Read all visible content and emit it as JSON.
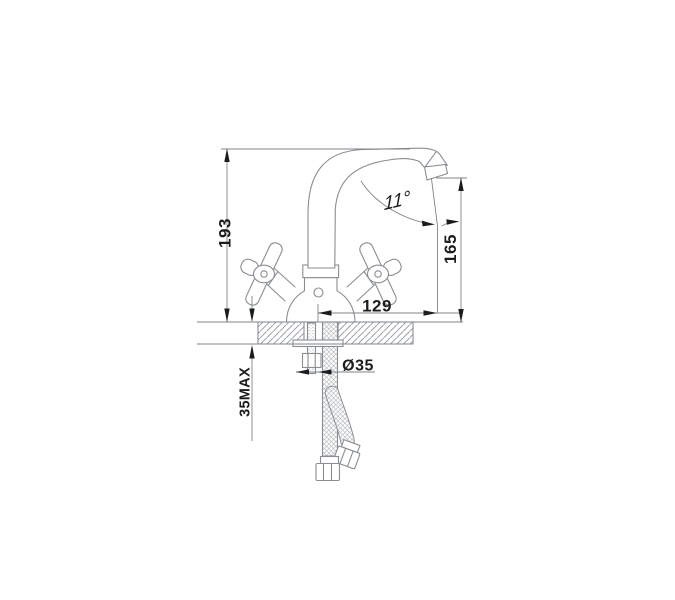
{
  "drawing": {
    "labels": {
      "total_height": "193",
      "spout_outlet_height": "165",
      "spout_reach": "129",
      "mounting_thickness": "35MAX",
      "mounting_hole_diameter": "Ø35",
      "spout_angle": "11°"
    },
    "colors": {
      "background": "#ffffff",
      "line": "#8a8e92",
      "dimension_line": "#7f8489",
      "annotation": "#1b1c1e"
    }
  }
}
